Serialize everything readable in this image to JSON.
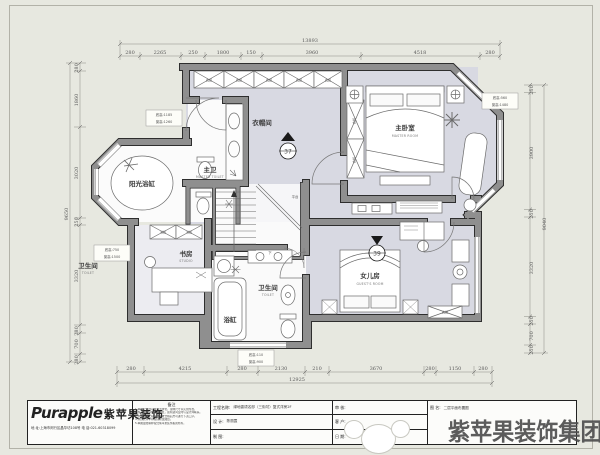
{
  "dims": {
    "top": {
      "total": "13893",
      "segments": [
        "280",
        "2265",
        "250",
        "1800",
        "150",
        "3960",
        "4518",
        "280"
      ]
    },
    "bottom": {
      "total": "12925",
      "segments": [
        "280",
        "4215",
        "280",
        "2130",
        "210",
        "3670",
        "280",
        "1150",
        "280"
      ]
    },
    "left": {
      "total": "9650",
      "segments": [
        "280",
        "1860",
        "3020",
        "250",
        "3320",
        "280",
        "700",
        "280"
      ]
    },
    "right": {
      "total": "9040",
      "segments": [
        "250",
        "3900",
        "250",
        "3320",
        "250",
        "700",
        "250"
      ]
    }
  },
  "rooms": {
    "cloakroom": "衣帽间",
    "master_toilet_cn": "主卫",
    "master_toilet_en": "MASTER TOILET",
    "master_room_cn": "主卧室",
    "master_room_en": "MASTER ROOM",
    "sun_tub": "阳光浴缸",
    "studio_cn": "书房",
    "studio_en": "STUDIO",
    "toilet_small_cn": "卫生间",
    "toilet_small_en": "TOILET",
    "bathroom_cn": "卫生间",
    "bathroom_en": "TOILET",
    "tub": "浴缸",
    "daughter_cn": "女儿房",
    "daughter_en": "GUEST'S ROOM",
    "landing": "平台",
    "down": "下"
  },
  "labels": {
    "wardrobe": "衣柜",
    "bookcase": "书柜"
  },
  "markers": {
    "stair": "37",
    "daughter": "39"
  },
  "notes": {
    "n1a": "底高:1185",
    "n1b": "窗高:1260",
    "n2a": "底高:750",
    "n2b": "窗高:1500",
    "n3a": "底高:560",
    "n3b": "窗高:1480",
    "n4a": "底高:110",
    "n4b": "窗高:900"
  },
  "titleblock": {
    "logo_en": "Purapple",
    "logo_cn": "紫苹果装饰",
    "address": "地 址:上海市闵行区晶华坊108号    电 话:021-60318099",
    "remark_title": "备注",
    "remarks": [
      "1.本图尺寸均以毫米为单位，现场尺寸以实测为准。",
      "2.施工前请仔细核对图纸，如有疑问及时与设计师联系。",
      "3.水电隐蔽工程须经验收合格后方可进行下道工序。",
      "4.未经允许不得擅自修改图纸。",
      "5.本图最终解释权归紫苹果装饰集团所有。"
    ],
    "project_label": "工程名称:",
    "project": "绿地香颂名邸（三街坊）复式洋房2F",
    "design_label": "设  计:",
    "design": "陈丽霞",
    "draft_label": "制  图:",
    "draft": "",
    "audit_label": "审  核:",
    "audit": "",
    "client_label": "客  户:",
    "client": "",
    "date_label": "日  期:",
    "date": "",
    "drawing_label": "图 名:",
    "drawing": "二层平面布置图"
  },
  "watermark": "紫苹果装饰集团"
}
